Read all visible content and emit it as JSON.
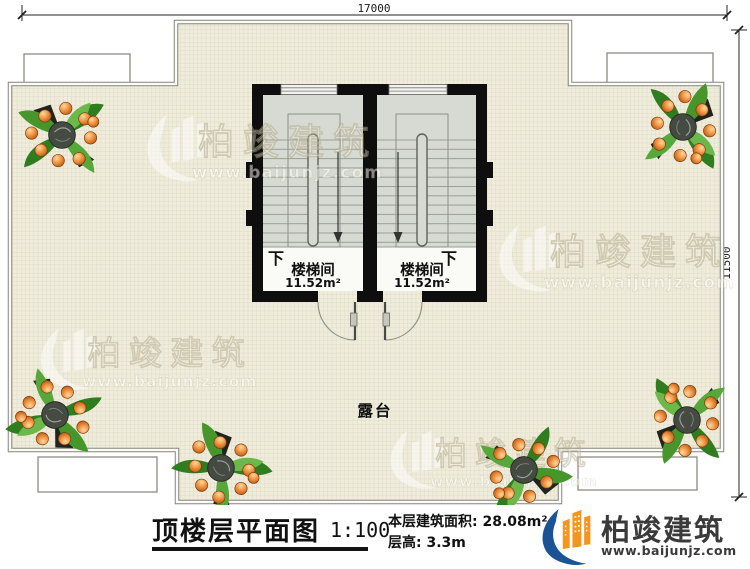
{
  "dimensions": {
    "top": "17000",
    "right": "11500"
  },
  "plan": {
    "terrace_label": "露台",
    "stairwells": [
      {
        "name": "楼梯间",
        "area": "11.52m²",
        "down_label": "下"
      },
      {
        "name": "楼梯间",
        "area": "11.52m²",
        "down_label": "下"
      }
    ]
  },
  "watermark": {
    "brand": "柏竣建筑",
    "url": "www.baijunjz.com",
    "logo_icon": "building-swoosh-logo"
  },
  "title_block": {
    "title": "顶楼层平面图",
    "scale": "1:100",
    "area_label": "本层建筑面积:",
    "area_value": "28.08m²",
    "height_label": "层高:",
    "height_value": "3.3m"
  },
  "logo": {
    "brand": "柏竣建筑",
    "url": "www.baijunjz.com"
  },
  "colors": {
    "terrace_fill": "#efecdc",
    "terrace_grid": "#dcd6bf",
    "stair_fill": "#d6dad2",
    "wall": "#0e0e0e",
    "brand_orange": "#f7941d",
    "brand_blue": "#1c5394"
  }
}
